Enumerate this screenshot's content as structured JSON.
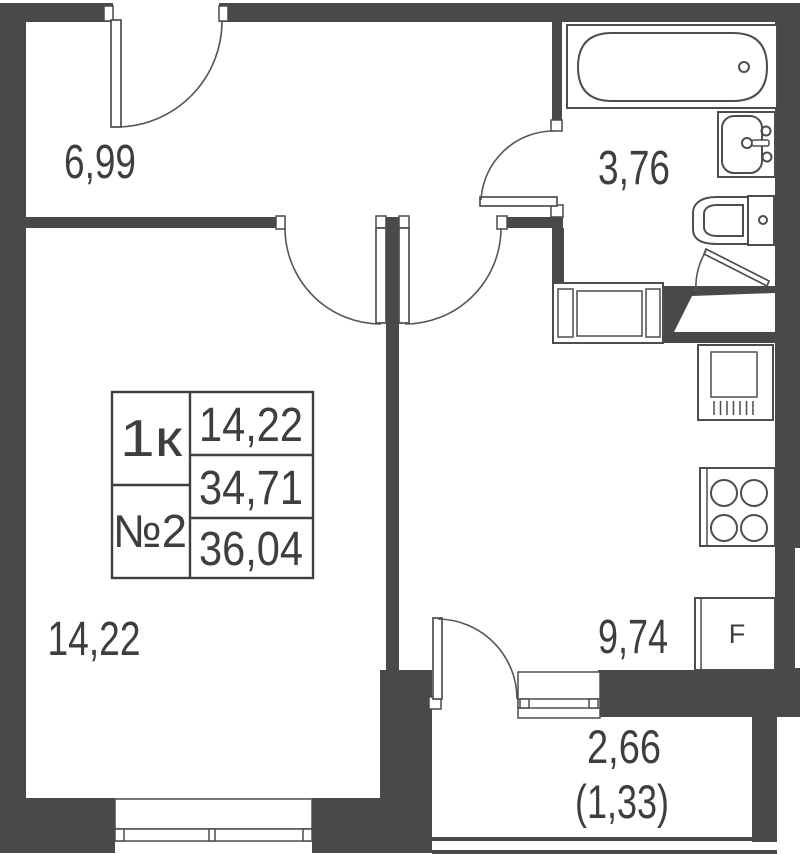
{
  "unit_card": {
    "type": "1к",
    "number": "№2",
    "room_area": "14,22",
    "living_area": "34,71",
    "total_area": "36,04"
  },
  "rooms": {
    "hallway_area": "6,99",
    "bathroom_area": "3,76",
    "living_room_area": "14,22",
    "kitchen_area": "9,74",
    "balcony_area": "2,66",
    "balcony_reduced_area": "(1,33)"
  },
  "appliances": {
    "fridge_label": "F"
  },
  "colors": {
    "wall": "#494949",
    "fixture_line": "#4d4d4f",
    "text": "#3e3e40",
    "background": "#ffffff"
  }
}
